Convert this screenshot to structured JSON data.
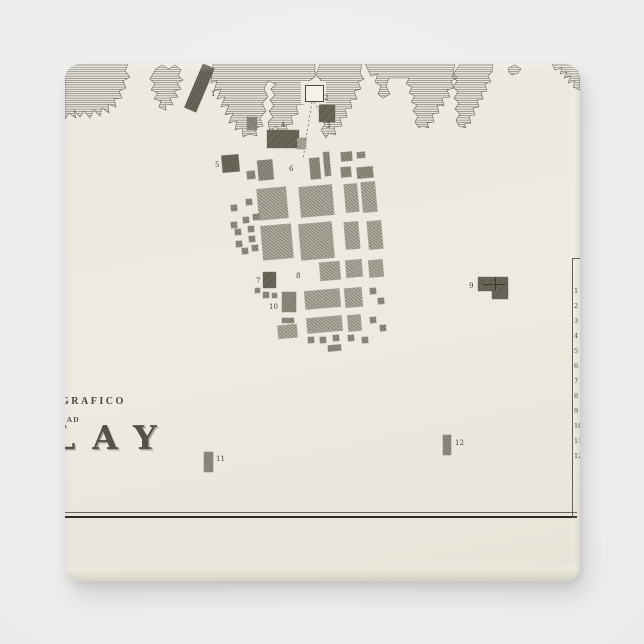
{
  "scene": {
    "background_color": "#efeeed"
  },
  "magnet": {
    "face_color": "#ecebe0",
    "ink_color": "#4c4840",
    "x": 65,
    "y": 64,
    "width": 515,
    "height": 517,
    "corner_radius": 15
  },
  "map": {
    "title": {
      "line1": "GRAFICO",
      "line2": "DAD",
      "line3": "LAY"
    },
    "labels": [
      {
        "text": "1",
        "x": 146,
        "y": 27
      },
      {
        "text": "2",
        "x": 259,
        "y": 31
      },
      {
        "text": "3",
        "x": 261,
        "y": 59
      },
      {
        "text": "4",
        "x": 216,
        "y": 58
      },
      {
        "text": "5",
        "x": 150,
        "y": 98
      },
      {
        "text": "6",
        "x": 224,
        "y": 102
      },
      {
        "text": "7",
        "x": 191,
        "y": 214
      },
      {
        "text": "8",
        "x": 231,
        "y": 209
      },
      {
        "text": "9",
        "x": 404,
        "y": 219
      },
      {
        "text": "10",
        "x": 204,
        "y": 240
      },
      {
        "text": "11",
        "x": 151,
        "y": 392
      },
      {
        "text": "12",
        "x": 390,
        "y": 376
      }
    ],
    "legend": {
      "numbers": [
        "1",
        "2",
        "3",
        "4",
        "5",
        "6",
        "7",
        "8",
        "9",
        "10",
        "11",
        "12"
      ],
      "num_x": 509,
      "y_start": 224,
      "y_step": 15,
      "line_x": 507,
      "line_top": 194,
      "line_bottom": 452
    },
    "border_lines": {
      "thin_y": 448,
      "thick_y": 451.5,
      "x_start": 0,
      "x_end": 512
    },
    "pier": {
      "x": 128,
      "y": 0,
      "w": 13,
      "h": 48,
      "rotation": 23
    },
    "church_cross": {
      "h_bar": [
        417,
        220,
        23,
        1
      ],
      "v_bar": [
        430,
        213,
        1,
        14
      ]
    },
    "dashed_routes": [
      "M247,38 L243,62 L238,96",
      "M249,38 L256,50"
    ],
    "coast_paths": [
      "M0,0 L63,0 L60,7 L65,13 L58,17 L61,24 L54,27 L57,34 L49,35 L51,43 L43,40 L44,49 L37,44 L35,52 L29,46 L25,54 L19,47 L15,53 L9,46 L11,54 L4,49 L0,55 Z",
      "M91,5 L97,1 L104,5 L110,1 L116,6 L113,12 L118,16 L112,19 L116,25 L109,27 L113,33 L105,34 L108,41 L100,40 L101,46 L94,43 L96,37 L89,35 L93,29 L86,26 L90,20 L85,15 Z",
      "M148,0 L250,0 L250,13 L244,17 L247,23 L241,23 L243,30 L236,32 L239,40 L231,41 L233,50 L226,52 L228,60 L221,61 L223,69 L215,70 L211,62 L205,68 L203,58 L208,53 L204,47 L209,42 L205,36 L210,31 L206,25 L211,20 L203,17 L199,25 L203,33 L197,39 L201,47 L195,54 L198,62 L190,64 L192,72 L184,70 L178,73 L177,64 L170,66 L172,57 L164,59 L168,49 L160,51 L164,41 L156,43 L160,33 L152,35 L156,25 L149,27 L152,17 L146,19 Z",
      "M255,0 L297,0 L295,9 L299,15 L293,18 L296,25 L289,27 L292,35 L285,36 L287,44 L280,45 L282,53 L275,54 L277,62 L269,63 L271,71 L264,69 L261,74 L256,66 L260,60 L255,55 L259,49 L254,44 L258,38 L253,33 L257,27 L252,22 L256,16 L251,11 Z",
      "M300,0 L390,0 L388,8 L392,14 L386,17 L389,24 L382,26 L385,33 L377,34 L379,42 L372,41 L374,49 L367,50 L369,58 L362,59 L364,64 L357,62 L354,64 L350,58 L353,52 L348,47 L352,41 L346,38 L350,32 L344,29 L347,23 L341,20 L344,14 L324,14 L321,22 L325,30 L318,34 L313,30 L316,22 L310,18 L313,10 L306,12 L303,6 Z",
      "M395,0 L428,0 L427,8 L423,12 L426,18 L420,20 L422,27 L416,28 L418,35 L412,36 L414,43 L408,44 L410,51 L404,52 L406,59 L399,60 L401,64 L394,62 L391,56 L395,50 L390,45 L394,39 L389,34 L393,28 L388,23 L392,17 L387,12 L391,6 Z",
      "M443,4 L450,1 L456,5 L453,9 L447,11 L444,8 Z",
      "M487,0 L515,0 L515,26 L508,23 L510,17 L503,19 L506,12 L499,14 L502,8 L495,10 L497,4 L490,6 Z"
    ],
    "buildings": [
      {
        "x": 240,
        "y": 21,
        "w": 17,
        "h": 15,
        "shade": "white",
        "rot": 0
      },
      {
        "x": 254,
        "y": 41,
        "w": 16,
        "h": 17,
        "shade": "dark",
        "rot": 0
      },
      {
        "x": 182,
        "y": 53,
        "w": 10,
        "h": 13,
        "shade": "med",
        "rot": 0
      },
      {
        "x": 202,
        "y": 66,
        "w": 32,
        "h": 18,
        "shade": "dark",
        "rot": 0
      },
      {
        "x": 232,
        "y": 74,
        "w": 9,
        "h": 11,
        "shade": "light",
        "rot": 0
      },
      {
        "x": 157,
        "y": 91,
        "w": 17,
        "h": 17,
        "shade": "dark",
        "rot": -5
      },
      {
        "x": 182,
        "y": 107,
        "w": 8,
        "h": 8,
        "shade": "med",
        "rot": -5
      },
      {
        "x": 193,
        "y": 96,
        "w": 15,
        "h": 20,
        "shade": "med",
        "rot": -5
      },
      {
        "x": 245,
        "y": 94,
        "w": 10,
        "h": 21,
        "shade": "med",
        "rot": -5
      },
      {
        "x": 259,
        "y": 88,
        "w": 6,
        "h": 24,
        "shade": "med",
        "rot": -5
      },
      {
        "x": 276,
        "y": 88,
        "w": 11,
        "h": 9,
        "shade": "med",
        "rot": -5
      },
      {
        "x": 276,
        "y": 103,
        "w": 10,
        "h": 10,
        "shade": "med",
        "rot": -5
      },
      {
        "x": 292,
        "y": 88,
        "w": 8,
        "h": 6,
        "shade": "med",
        "rot": -5
      },
      {
        "x": 292,
        "y": 103,
        "w": 16,
        "h": 11,
        "shade": "med",
        "rot": -5
      },
      {
        "x": 193,
        "y": 124,
        "w": 29,
        "h": 31,
        "shade": "light",
        "rot": -5
      },
      {
        "x": 235,
        "y": 122,
        "w": 33,
        "h": 30,
        "shade": "light",
        "rot": -5
      },
      {
        "x": 280,
        "y": 120,
        "w": 13,
        "h": 28,
        "shade": "light",
        "rot": -5
      },
      {
        "x": 297,
        "y": 118,
        "w": 14,
        "h": 30,
        "shade": "light",
        "rot": -5
      },
      {
        "x": 197,
        "y": 161,
        "w": 30,
        "h": 34,
        "shade": "light",
        "rot": -5
      },
      {
        "x": 235,
        "y": 159,
        "w": 33,
        "h": 36,
        "shade": "light",
        "rot": -5
      },
      {
        "x": 280,
        "y": 158,
        "w": 14,
        "h": 27,
        "shade": "light",
        "rot": -5
      },
      {
        "x": 303,
        "y": 157,
        "w": 14,
        "h": 28,
        "shade": "light",
        "rot": -5
      },
      {
        "x": 255,
        "y": 198,
        "w": 20,
        "h": 18,
        "shade": "light",
        "rot": -5
      },
      {
        "x": 281,
        "y": 196,
        "w": 16,
        "h": 17,
        "shade": "light",
        "rot": -5
      },
      {
        "x": 304,
        "y": 196,
        "w": 14,
        "h": 17,
        "shade": "light",
        "rot": -5
      },
      {
        "x": 240,
        "y": 226,
        "w": 35,
        "h": 18,
        "shade": "light",
        "rot": -5
      },
      {
        "x": 280,
        "y": 224,
        "w": 17,
        "h": 19,
        "shade": "light",
        "rot": -5
      },
      {
        "x": 305,
        "y": 224,
        "w": 6,
        "h": 6,
        "shade": "med",
        "rot": -5
      },
      {
        "x": 313,
        "y": 234,
        "w": 6,
        "h": 6,
        "shade": "med",
        "rot": -5
      },
      {
        "x": 242,
        "y": 253,
        "w": 35,
        "h": 15,
        "shade": "light",
        "rot": -5
      },
      {
        "x": 283,
        "y": 251,
        "w": 13,
        "h": 16,
        "shade": "light",
        "rot": -5
      },
      {
        "x": 305,
        "y": 253,
        "w": 6,
        "h": 6,
        "shade": "med",
        "rot": -5
      },
      {
        "x": 315,
        "y": 261,
        "w": 6,
        "h": 6,
        "shade": "med",
        "rot": -5
      },
      {
        "x": 213,
        "y": 261,
        "w": 19,
        "h": 13,
        "shade": "light",
        "rot": -5
      },
      {
        "x": 243,
        "y": 273,
        "w": 6,
        "h": 6,
        "shade": "med",
        "rot": -5
      },
      {
        "x": 255,
        "y": 273,
        "w": 6,
        "h": 6,
        "shade": "med",
        "rot": -5
      },
      {
        "x": 268,
        "y": 271,
        "w": 6,
        "h": 6,
        "shade": "med",
        "rot": -5
      },
      {
        "x": 283,
        "y": 271,
        "w": 6,
        "h": 6,
        "shade": "med",
        "rot": -5
      },
      {
        "x": 297,
        "y": 273,
        "w": 6,
        "h": 6,
        "shade": "med",
        "rot": -5
      },
      {
        "x": 263,
        "y": 281,
        "w": 13,
        "h": 6,
        "shade": "med",
        "rot": -5
      },
      {
        "x": 166,
        "y": 141,
        "w": 6,
        "h": 6,
        "shade": "med",
        "rot": -5
      },
      {
        "x": 181,
        "y": 135,
        "w": 6,
        "h": 6,
        "shade": "med",
        "rot": -5
      },
      {
        "x": 166,
        "y": 158,
        "w": 6,
        "h": 6,
        "shade": "med",
        "rot": -5
      },
      {
        "x": 178,
        "y": 153,
        "w": 6,
        "h": 6,
        "shade": "med",
        "rot": -5
      },
      {
        "x": 188,
        "y": 150,
        "w": 6,
        "h": 6,
        "shade": "med",
        "rot": -5
      },
      {
        "x": 170,
        "y": 165,
        "w": 6,
        "h": 6,
        "shade": "med",
        "rot": -5
      },
      {
        "x": 183,
        "y": 162,
        "w": 6,
        "h": 6,
        "shade": "med",
        "rot": -5
      },
      {
        "x": 171,
        "y": 177,
        "w": 6,
        "h": 6,
        "shade": "med",
        "rot": -5
      },
      {
        "x": 184,
        "y": 172,
        "w": 6,
        "h": 6,
        "shade": "med",
        "rot": -5
      },
      {
        "x": 177,
        "y": 184,
        "w": 6,
        "h": 6,
        "shade": "med",
        "rot": -5
      },
      {
        "x": 187,
        "y": 181,
        "w": 6,
        "h": 6,
        "shade": "med",
        "rot": -5
      },
      {
        "x": 198,
        "y": 208,
        "w": 13,
        "h": 16,
        "shade": "dark",
        "rot": 0
      },
      {
        "x": 190,
        "y": 224,
        "w": 5,
        "h": 5,
        "shade": "med",
        "rot": 0
      },
      {
        "x": 198,
        "y": 228,
        "w": 6,
        "h": 6,
        "shade": "med",
        "rot": 0
      },
      {
        "x": 207,
        "y": 229,
        "w": 5,
        "h": 5,
        "shade": "med",
        "rot": 0
      },
      {
        "x": 217,
        "y": 228,
        "w": 14,
        "h": 20,
        "shade": "med",
        "rot": 0
      },
      {
        "x": 217,
        "y": 254,
        "w": 12,
        "h": 5,
        "shade": "med",
        "rot": 0
      },
      {
        "x": 413,
        "y": 213,
        "w": 30,
        "h": 14,
        "shade": "dark",
        "rot": 0
      },
      {
        "x": 427,
        "y": 227,
        "w": 16,
        "h": 8,
        "shade": "dark",
        "rot": 0
      },
      {
        "x": 139,
        "y": 388,
        "w": 9,
        "h": 20,
        "shade": "med",
        "rot": 0
      },
      {
        "x": 378,
        "y": 371,
        "w": 8,
        "h": 20,
        "shade": "med",
        "rot": 0
      }
    ]
  },
  "palette": {
    "block_light": "#b0ada0",
    "block_med": "#979487",
    "block_dark": "#747062",
    "block_white": "#f3f1e8",
    "line_ink": "#2e2c27",
    "engraving_ink": "#57534a"
  }
}
